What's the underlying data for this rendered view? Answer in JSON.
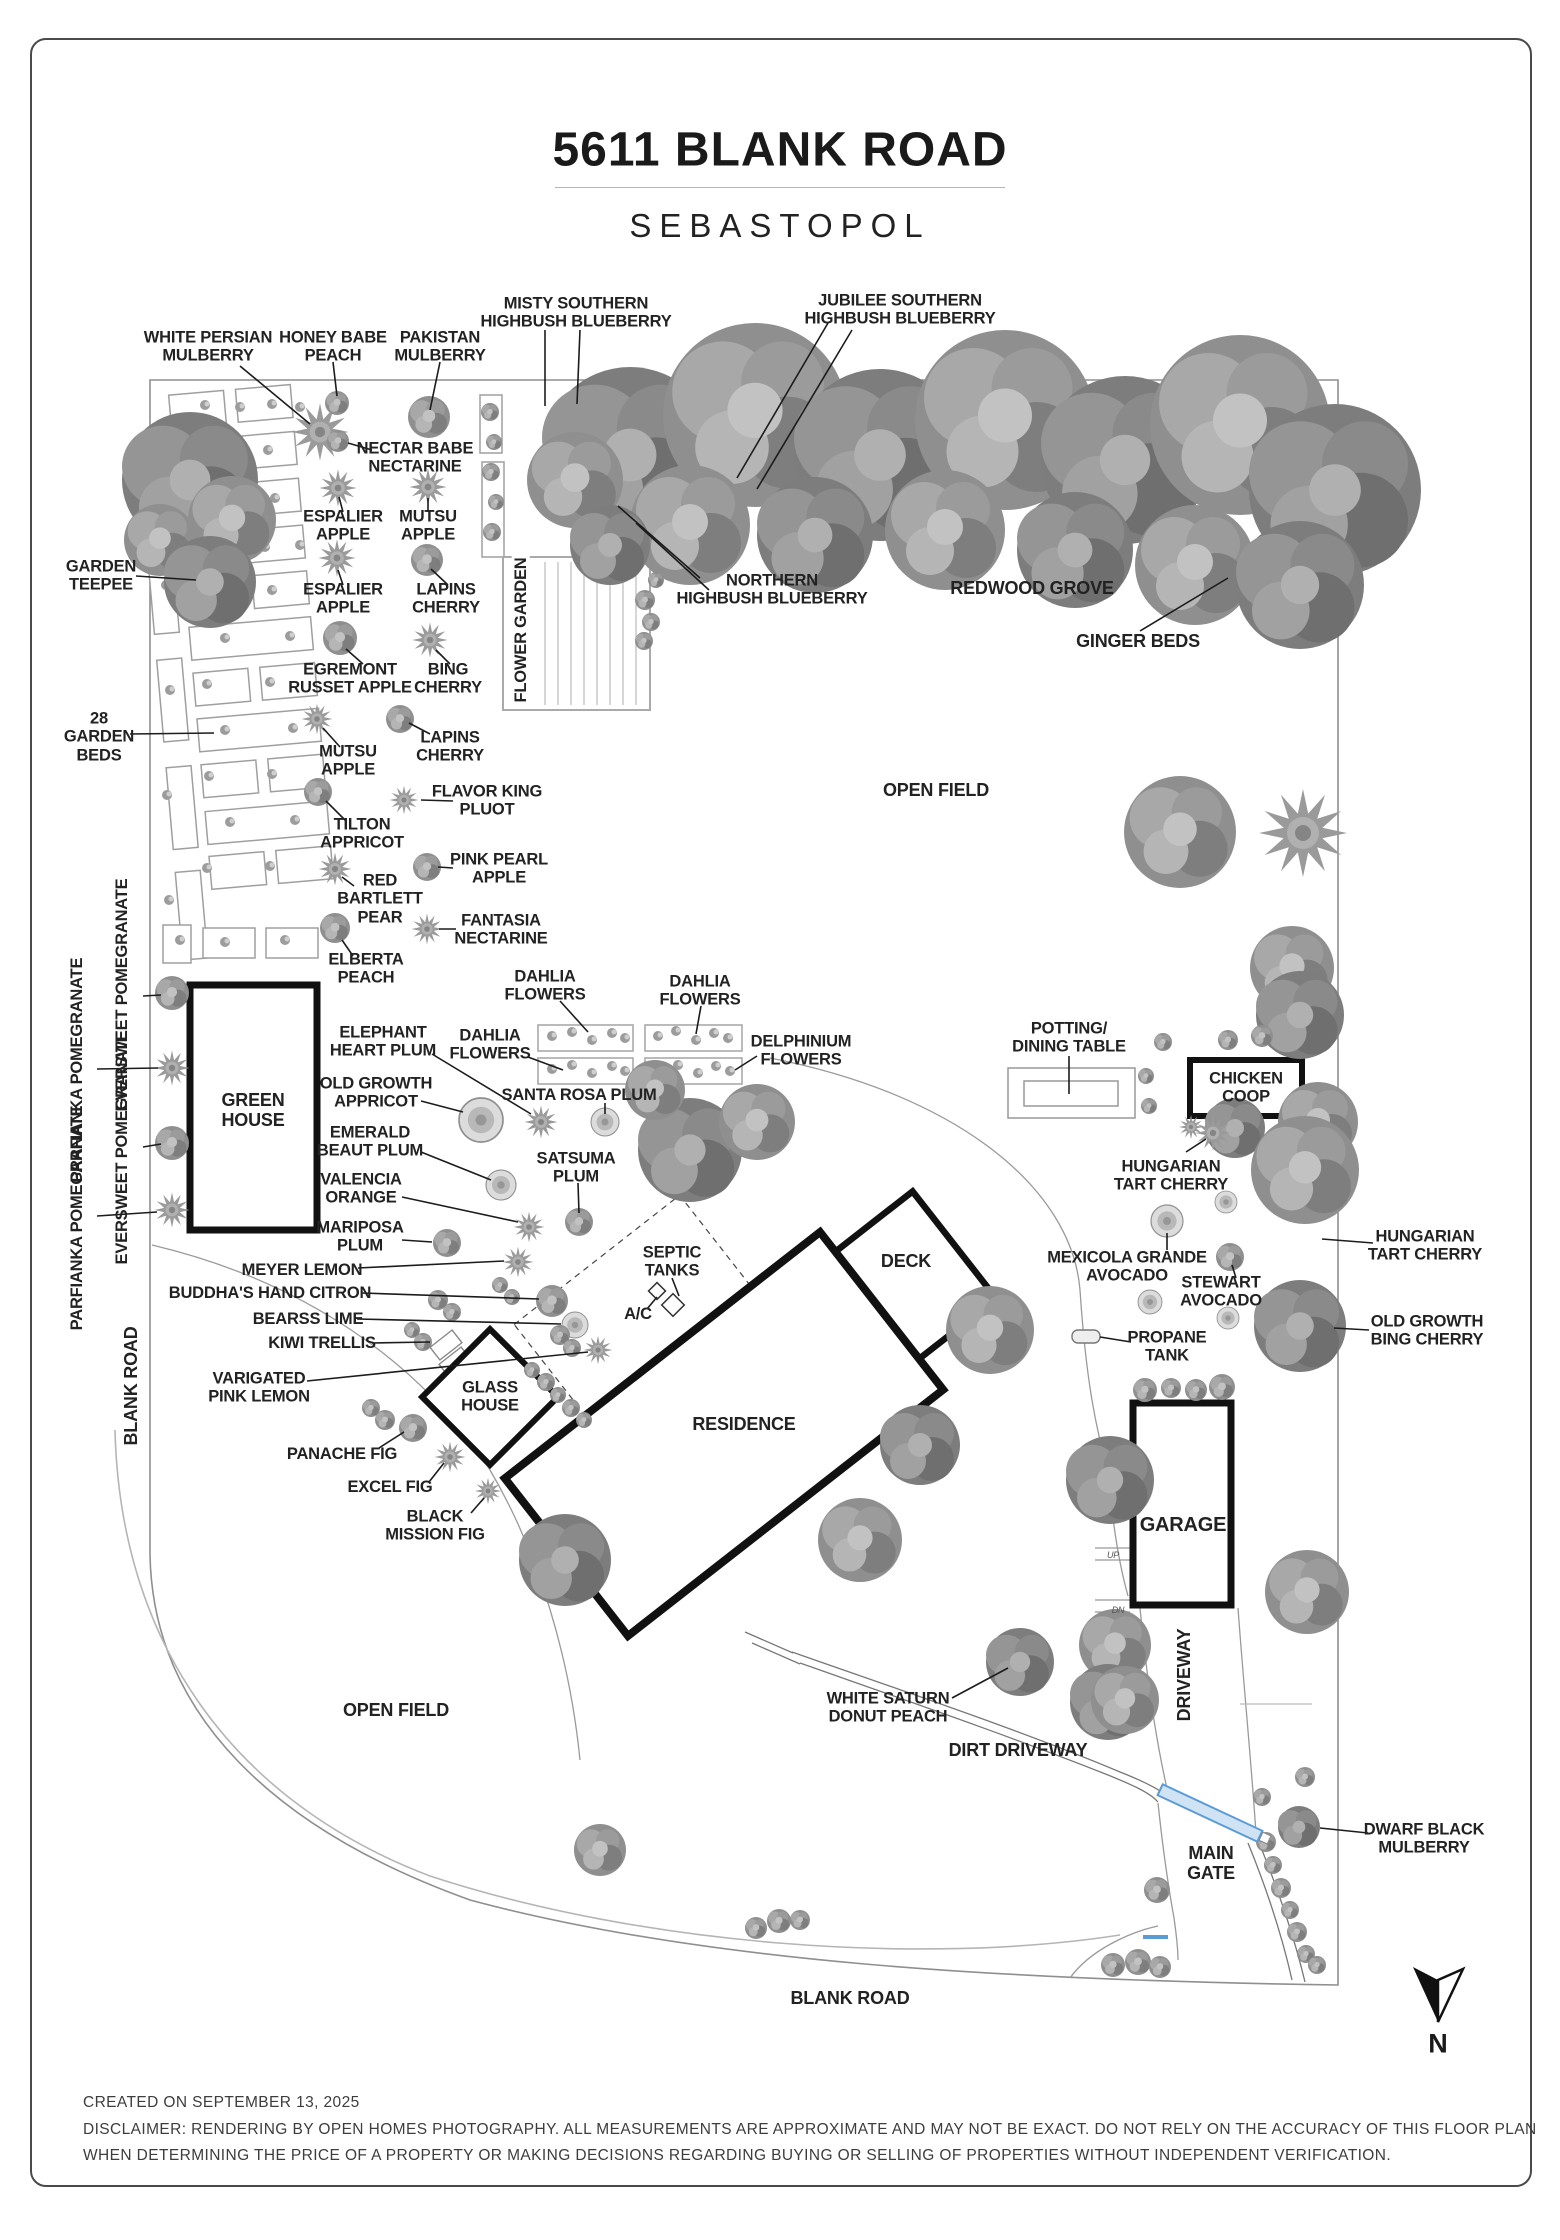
{
  "title": {
    "address": "5611 BLANK ROAD",
    "city": "SEBASTOPOL"
  },
  "compass": {
    "letter": "N"
  },
  "roads": {
    "blank_road_left": "BLANK ROAD",
    "blank_road_bottom": "BLANK ROAD",
    "dirt_driveway": "DIRT DRIVEWAY",
    "driveway": "DRIVEWAY",
    "main_gate": "MAIN\nGATE"
  },
  "fields": {
    "open_field_top": "OPEN FIELD",
    "open_field_bottom": "OPEN FIELD"
  },
  "structures": {
    "green_house": "GREEN\nHOUSE",
    "glass_house": "GLASS\nHOUSE",
    "chicken_coop": "CHICKEN\nCOOP",
    "garage": "GARAGE",
    "residence": "RESIDENCE",
    "deck": "DECK",
    "flower_garden": "FLOWER GARDEN",
    "potting_table": "POTTING/\nDINING TABLE",
    "septic_tanks": "SEPTIC\nTANKS",
    "ac_unit": "A/C",
    "propane_tank": "PROPANE\nTANK",
    "kiwi_trellis": "KIWI TRELLIS",
    "garden_teepee": "GARDEN\nTEEPEE",
    "garden_beds_28": "28\nGARDEN\nBEDS",
    "up": "UP",
    "dn": "DN"
  },
  "plants": {
    "white_persian_mulberry": "WHITE PERSIAN\nMULBERRY",
    "honey_babe_peach": "HONEY BABE\nPEACH",
    "pakistan_mulberry": "PAKISTAN\nMULBERRY",
    "misty_blueberry": "MISTY SOUTHERN\nHIGHBUSH BLUEBERRY",
    "jubilee_blueberry": "JUBILEE SOUTHERN\nHIGHBUSH BLUEBERRY",
    "nectar_babe_nectarine": "NECTAR BABE\nNECTARINE",
    "espalier_apple_1": "ESPALIER\nAPPLE",
    "espalier_apple_2": "ESPALIER\nAPPLE",
    "mutsu_apple_1": "MUTSU\nAPPLE",
    "mutsu_apple_2": "MUTSU\nAPPLE",
    "lapins_cherry_1": "LAPINS\nCHERRY",
    "lapins_cherry_2": "LAPINS\nCHERRY",
    "egremont_russet_apple": "EGREMONT\nRUSSET APPLE",
    "bing_cherry": "BING\nCHERRY",
    "northern_blueberry": "NORTHERN\nHIGHBUSH BLUEBERRY",
    "redwood_grove": "REDWOOD GROVE",
    "ginger_beds": "GINGER BEDS",
    "flavor_king_pluot": "FLAVOR KING\nPLUOT",
    "tilton_appricot": "TILTON\nAPPRICOT",
    "pink_pearl_apple": "PINK PEARL\nAPPLE",
    "red_bartlett_pear": "RED\nBARTLETT\nPEAR",
    "fantasia_nectarine": "FANTASIA\nNECTARINE",
    "elberta_peach": "ELBERTA\nPEACH",
    "dahlia_1": "DAHLIA\nFLOWERS",
    "dahlia_2": "DAHLIA\nFLOWERS",
    "dahlia_3": "DAHLIA\nFLOWERS",
    "delphinium_flowers": "DELPHINIUM\nFLOWERS",
    "santa_rosa_plum": "SANTA ROSA PLUM",
    "eversweet_pomegranate_1": "EVERSWEET\nPOMEGRANATE",
    "parfianka_pomegranate_1": "PARFIANKA\nPOMEGRANATE",
    "eversweet_pomegranate_2": "EVERSWEET\nPOMEGRANATE",
    "parfianka_pomegranate_2": "PARFIANKA\nPOMEGRANATE",
    "elephant_heart_plum": "ELEPHANT\nHEART PLUM",
    "old_growth_appricot": "OLD GROWTH\nAPPRICOT",
    "emerald_beaut_plum": "EMERALD\nBEAUT PLUM",
    "valencia_orange": "VALENCIA\nORANGE",
    "mariposa_plum": "MARIPOSA\nPLUM",
    "satsuma_plum": "SATSUMA\nPLUM",
    "meyer_lemon": "MEYER LEMON",
    "buddhas_hand_citron": "BUDDHA'S HAND CITRON",
    "bearss_lime": "BEARSS LIME",
    "varigated_pink_lemon": "VARIGATED\nPINK LEMON",
    "hungarian_tart_cherry_1": "HUNGARIAN\nTART CHERRY",
    "hungarian_tart_cherry_2": "HUNGARIAN\nTART CHERRY",
    "mexicola_grande_avocado": "MEXICOLA GRANDE\nAVOCADO",
    "stewart_avocado": "STEWART\nAVOCADO",
    "old_growth_bing_cherry": "OLD GROWTH\nBING CHERRY",
    "panache_fig": "PANACHE FIG",
    "excel_fig": "EXCEL FIG",
    "black_mission_fig": "BLACK\nMISSION FIG",
    "white_saturn_donut_peach": "WHITE SATURN\nDONUT PEACH",
    "dwarf_black_mulberry": "DWARF BLACK\nMULBERRY"
  },
  "footer": {
    "created": "CREATED ON SEPTEMBER 13, 2025",
    "disclaimer_line1": "DISCLAIMER: RENDERING BY OPEN HOMES PHOTOGRAPHY. ALL MEASUREMENTS ARE APPROXIMATE AND MAY NOT BE EXACT. DO NOT RELY ON THE ACCURACY OF THIS FLOOR PLAN",
    "disclaimer_line2": "WHEN DETERMINING THE PRICE OF A PROPERTY OR MAKING DECISIONS REGARDING BUYING OR SELLING OF PROPERTIES WITHOUT INDEPENDENT VERIFICATION."
  },
  "colors": {
    "gate_blue": "#5b9bd5",
    "gate_fill": "#cfe3f5",
    "tree_gray": "#8f8f8f",
    "line_gray": "#9a9a9a"
  }
}
